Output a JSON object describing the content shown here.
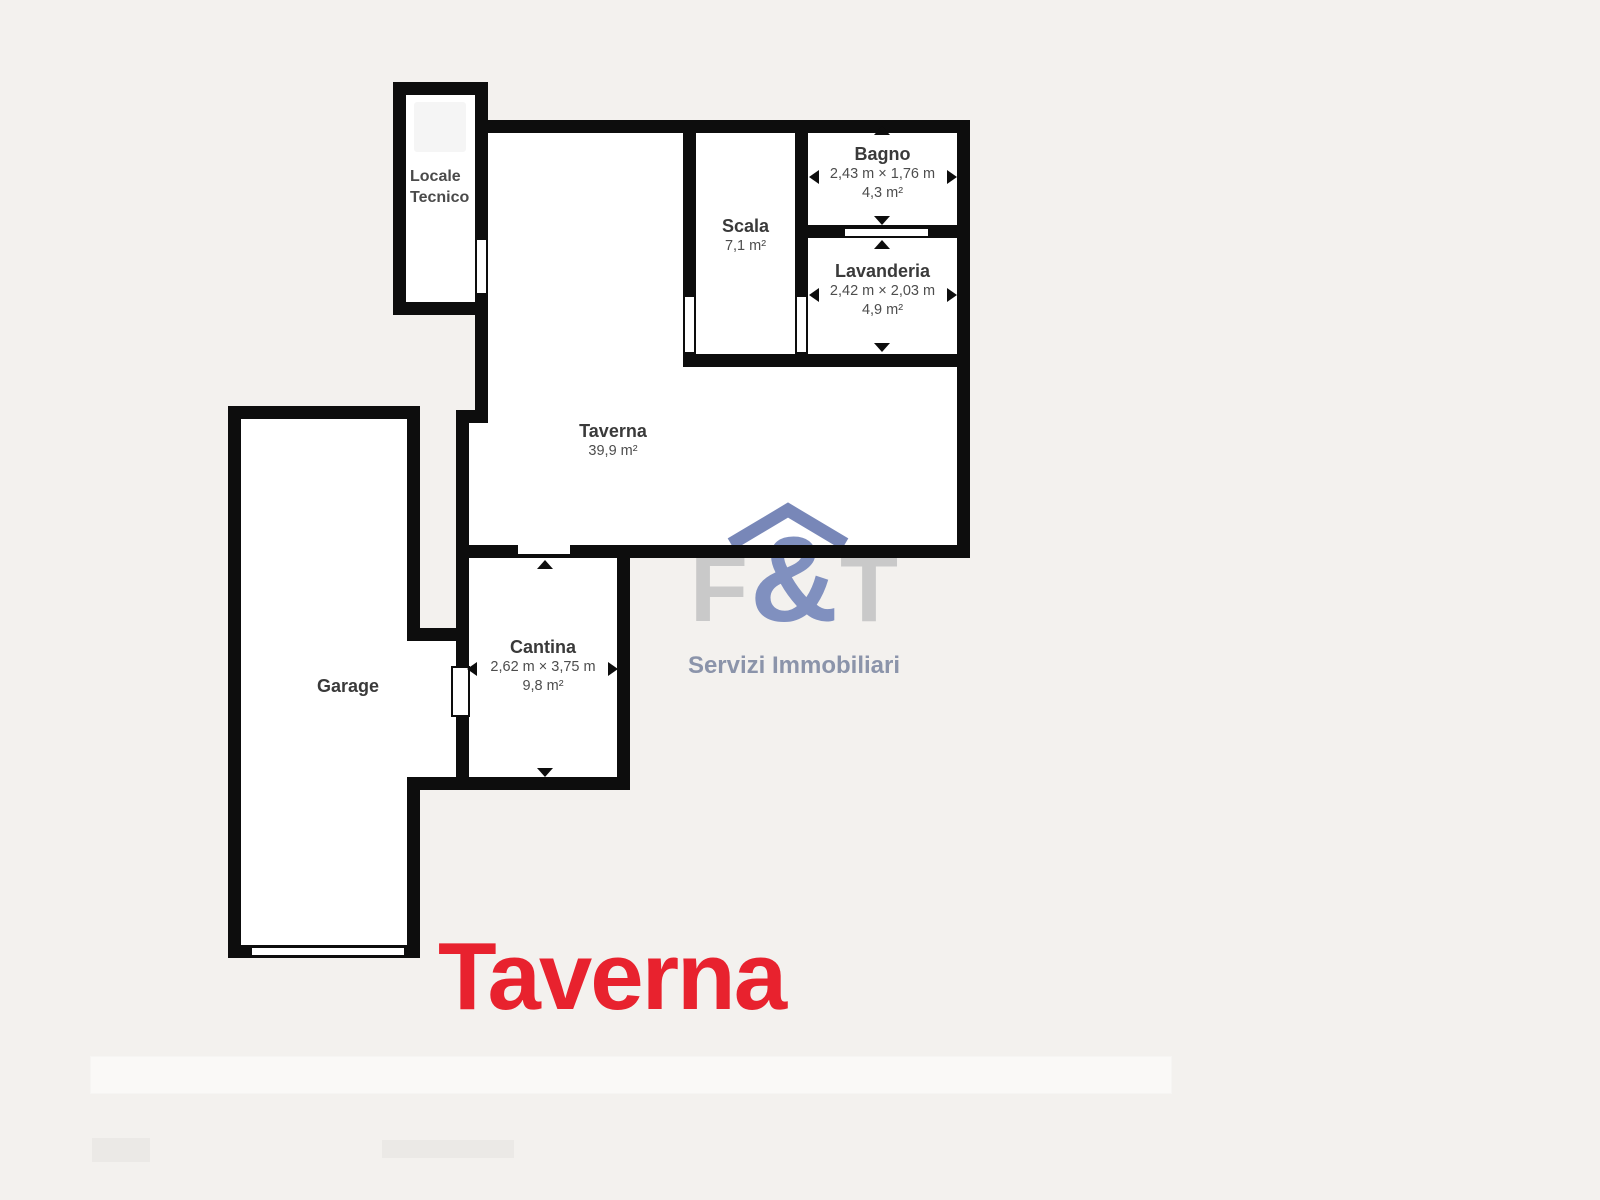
{
  "page": {
    "background_color": "#f3f1ee",
    "wall_color": "#0d0d0d",
    "room_fill_color": "#ffffff"
  },
  "floorplan": {
    "rooms": {
      "locale_tecnico": {
        "name_line1": "Locale",
        "name_line2": "Tecnico"
      },
      "scala": {
        "name": "Scala",
        "area": "7,1 m²"
      },
      "bagno": {
        "name": "Bagno",
        "dims": "2,43 m × 1,76 m",
        "area": "4,3 m²"
      },
      "lavanderia": {
        "name": "Lavanderia",
        "dims": "2,42 m × 2,03 m",
        "area": "4,9 m²"
      },
      "taverna": {
        "name": "Taverna",
        "area": "39,9 m²"
      },
      "cantina": {
        "name": "Cantina",
        "dims": "2,62 m × 3,75 m",
        "area": "9,8 m²"
      },
      "garage": {
        "name": "Garage"
      }
    }
  },
  "logo": {
    "letter_f": "F",
    "ampersand": "&",
    "letter_t": "T",
    "tagline": "Servizi Immobiliari",
    "letter_color": "#c9c9c9",
    "accent_color": "#8090bf",
    "tagline_color": "#8b94aa"
  },
  "floor_title": {
    "text": "Taverna",
    "color": "#e8222e"
  }
}
